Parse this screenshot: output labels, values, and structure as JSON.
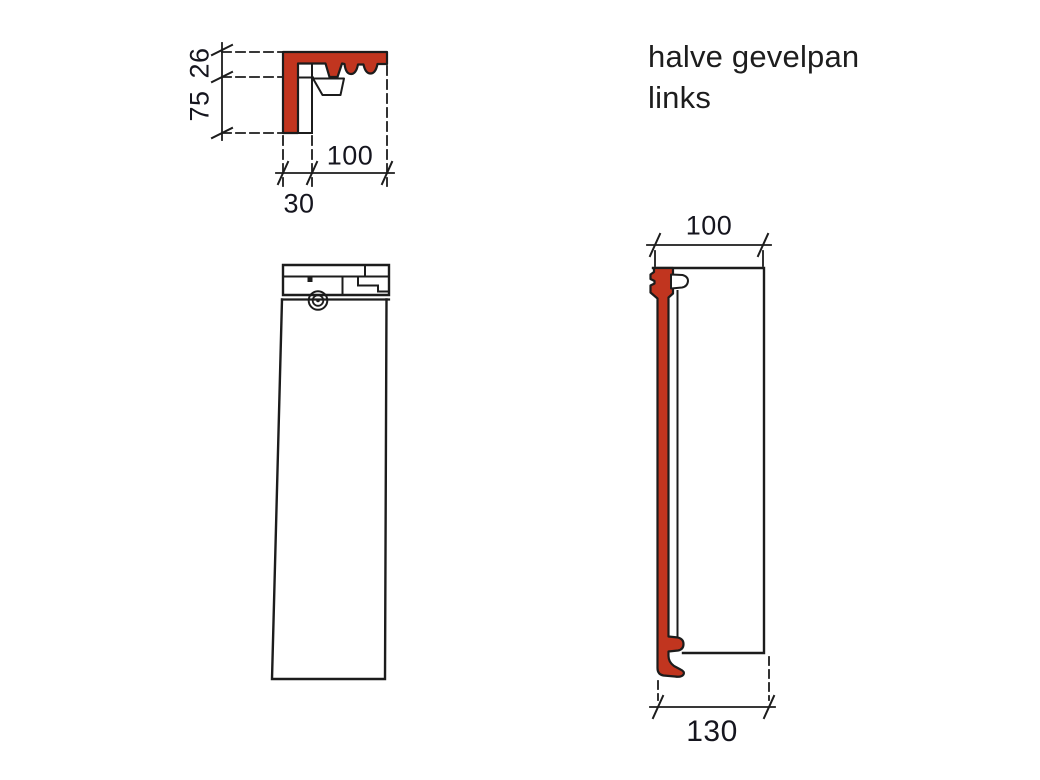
{
  "title": {
    "line1": "halve gevelpan",
    "line2": "links"
  },
  "detail_view": {
    "dim_top_thickness": "26",
    "dim_height": "75",
    "dim_width": "100",
    "dim_side_rib": "30"
  },
  "side_view": {
    "dim_top_width": "100",
    "dim_bottom_width": "130"
  },
  "colors": {
    "tile_red": "#c1351f",
    "line": "#1c1c1c",
    "dim_text": "#15151e"
  }
}
